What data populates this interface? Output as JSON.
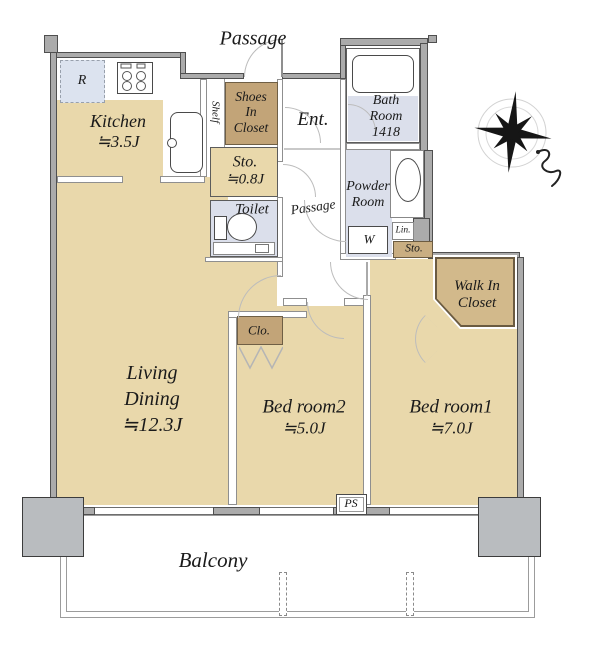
{
  "plan": {
    "passage_top": "Passage",
    "kitchen": {
      "name": "Kitchen",
      "size": "≒3.5J"
    },
    "refrigerator": "R",
    "shelf": "Shelf",
    "shoes_closet": [
      "Shoes",
      "In",
      "Closet"
    ],
    "entrance": "Ent.",
    "bath_room": [
      "Bath",
      "Room",
      "1418"
    ],
    "storage": {
      "name": "Sto.",
      "size": "≒0.8J"
    },
    "toilet": "Toilet",
    "passage_inner": "Passage",
    "powder_room": [
      "Powder",
      "Room"
    ],
    "washer": "W",
    "linen": "Lin.",
    "storage_small": "Sto.",
    "walk_in_closet": [
      "Walk In",
      "Closet"
    ],
    "closet": "Clo.",
    "living_dining": [
      "Living",
      "Dining",
      "≒12.3J"
    ],
    "bedroom2": {
      "name": "Bed room2",
      "size": "≒5.0J"
    },
    "bedroom1": {
      "name": "Bed room1",
      "size": "≒7.0J"
    },
    "pipe_space": "PS",
    "balcony": "Balcony"
  },
  "colors": {
    "floor_wood": "#e9d8ab",
    "floor_wet": "#dbdfeb",
    "closet_brown": "#c2a478",
    "walkin_brown": "#d2b98b",
    "wall_gray": "#ababab",
    "pillar_gray": "#b9bcbf"
  }
}
